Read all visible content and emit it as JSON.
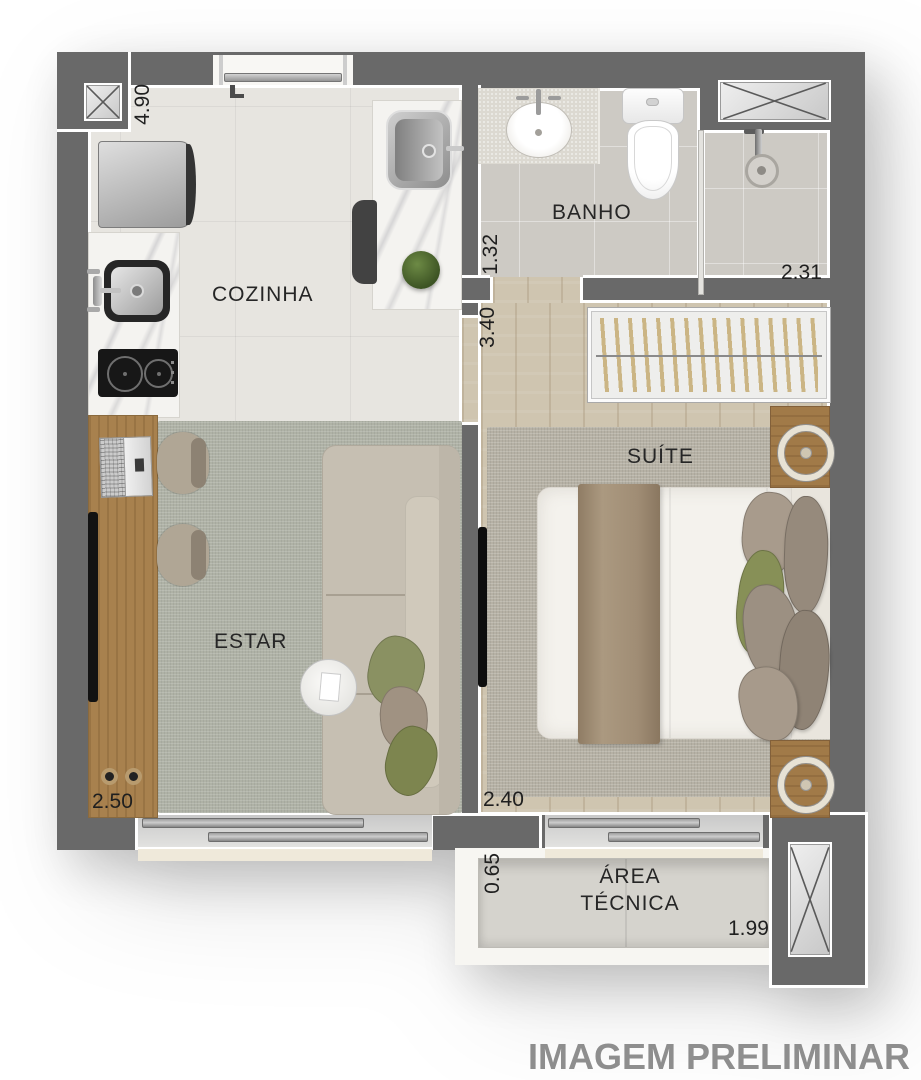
{
  "watermark": "IMAGEM PRELIMINAR",
  "rooms": {
    "cozinha": "COZINHA",
    "banho": "BANHO",
    "suite": "SUÍTE",
    "estar": "ESTAR",
    "area_tecnica_line1": "ÁREA",
    "area_tecnica_line2": "TÉCNICA"
  },
  "dims": {
    "cozinha_vertical": "4.90",
    "banho_vertical": "1.32",
    "shower_horizontal": "2.31",
    "hall_vertical": "3.40",
    "estar_horizontal": "2.50",
    "suite_horizontal": "2.40",
    "area_tecnica_vertical": "0.65",
    "area_tecnica_horizontal": "1.99"
  },
  "colors": {
    "wall": "#696969",
    "tile_floor": "#e7e5e0",
    "bath_floor": "#cdcac4",
    "wood_floor": "#cfc5b0",
    "rug_living": "#afb2a6",
    "rug_suite": "#b6b1a5",
    "wood_furniture": "#a8814e",
    "accent_green": "#8a9162",
    "label_text": "#262626",
    "watermark_text": "#8e8e8e"
  }
}
